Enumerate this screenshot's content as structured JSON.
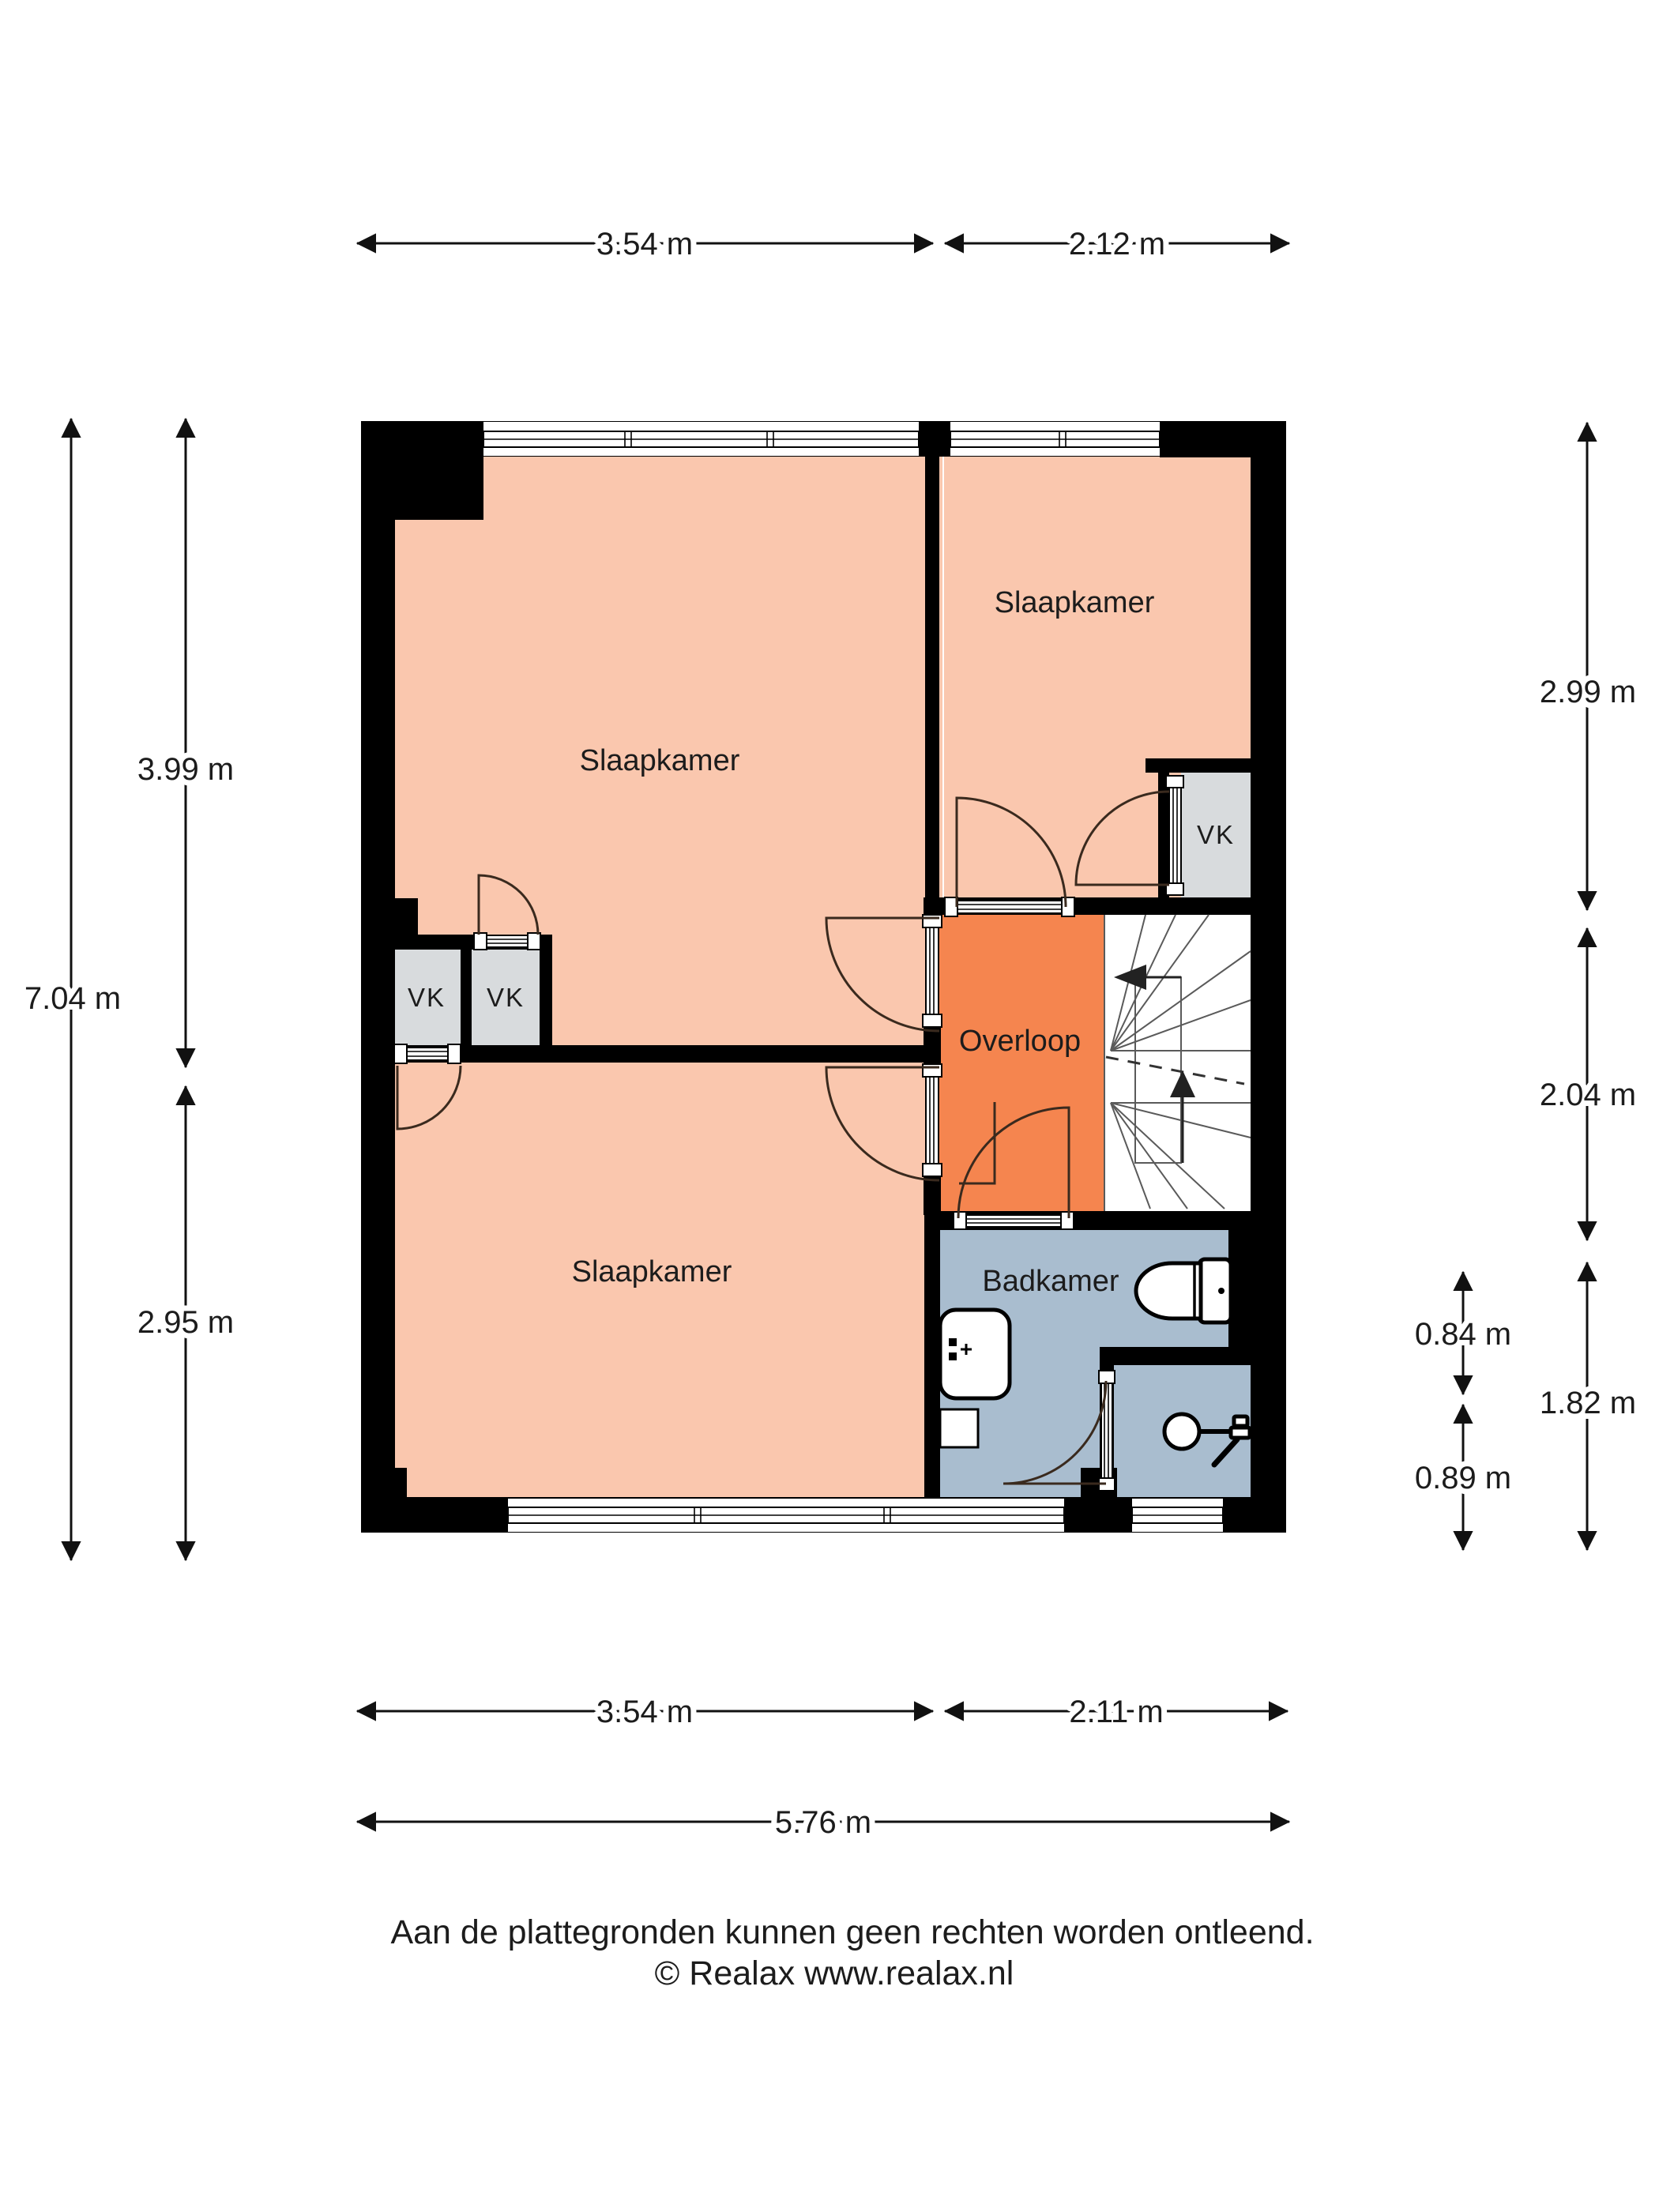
{
  "title": "Floor plan upper floor (plattegrond verdieping)",
  "colors": {
    "bedroom": "#FAC7AE",
    "landing": "#F5854F",
    "bathroom": "#A9BDCF",
    "closet": "#D8DBDD",
    "stairs": "#FFFFFF",
    "wall": "#000000"
  },
  "rooms": {
    "bedroom_top_left": "Slaapkamer",
    "bedroom_top_right": "Slaapkamer",
    "bedroom_bottom_left": "Slaapkamer",
    "landing": "Overloop",
    "bathroom": "Badkamer",
    "closet_top_right": "VK",
    "closet_left_1": "VK",
    "closet_left_2": "VK"
  },
  "dims": {
    "top_w1": "3.54 m",
    "top_w2": "2.12 m",
    "left_total": "7.04 m",
    "left_upper": "3.99 m",
    "left_lower": "2.95 m",
    "right_upper": "2.99 m",
    "right_mid": "2.04 m",
    "right_lower": "1.82 m",
    "right_bath": "0.84 m",
    "right_shower": "0.89 m",
    "bottom_w1": "3.54 m",
    "bottom_w2": "2.11 m",
    "bottom_total": "5.76 m"
  },
  "footer": {
    "disclaimer": "Aan de plattegronden kunnen geen rechten worden ontleend.",
    "copyright": "© Realax www.realax.nl"
  }
}
